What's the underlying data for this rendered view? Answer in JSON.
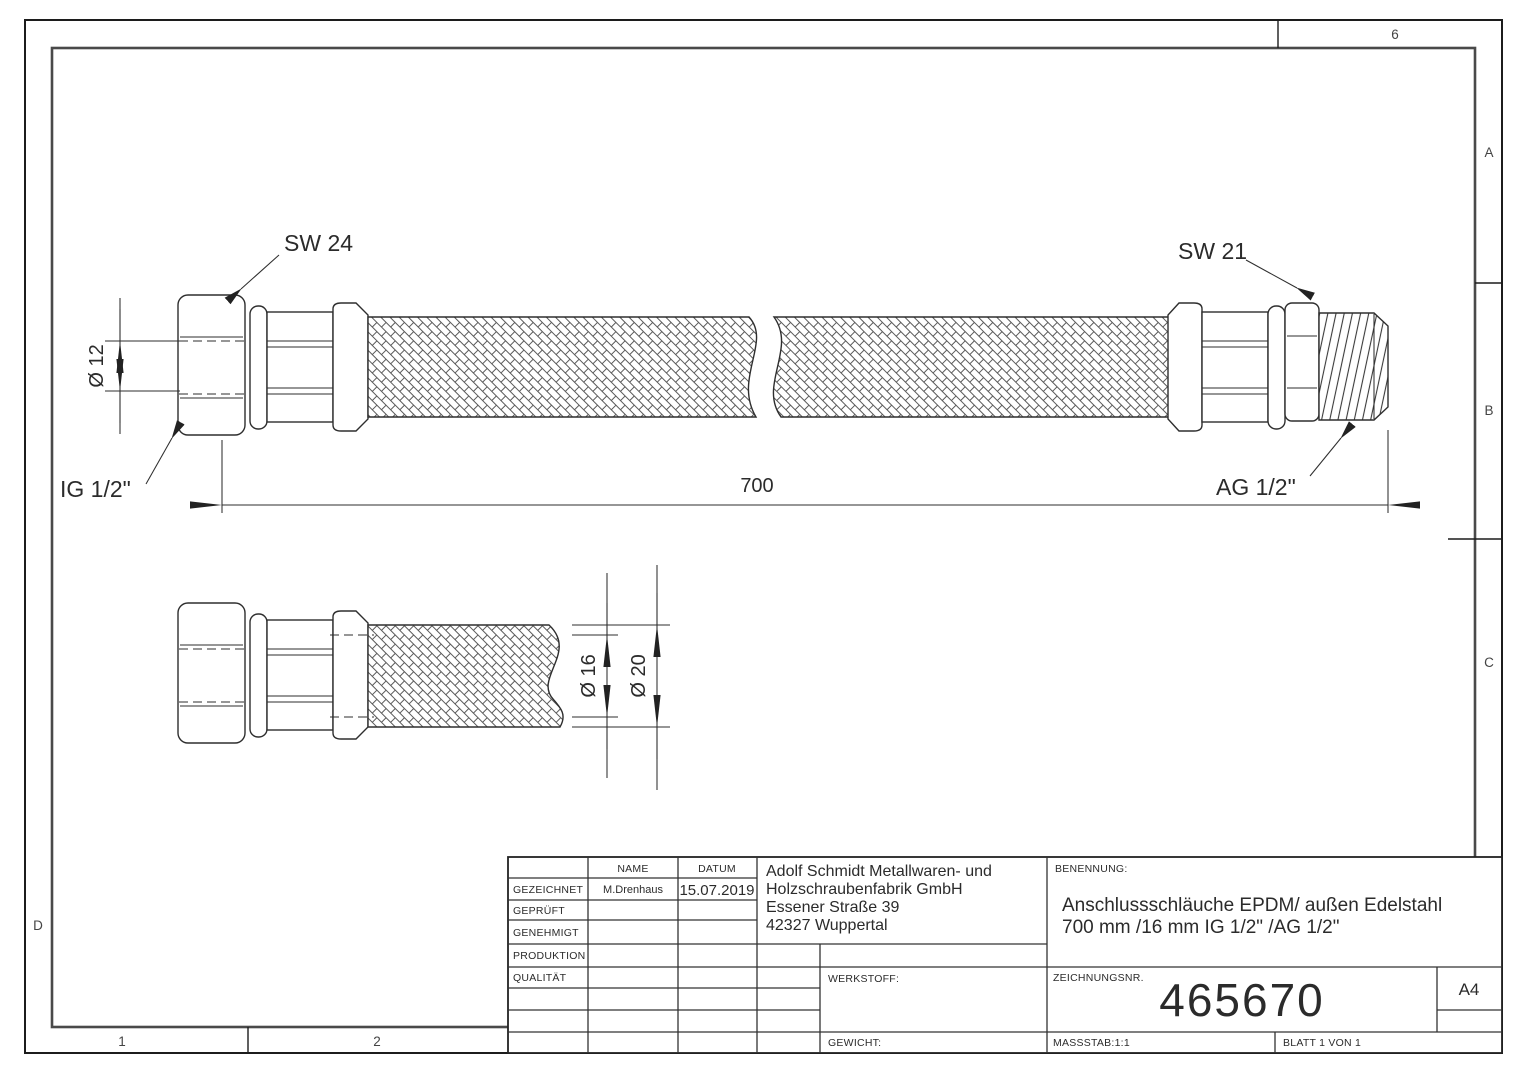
{
  "frame": {
    "zone_col_6": "6",
    "zone_col_1": "1",
    "zone_col_2": "2",
    "zone_row_a": "A",
    "zone_row_b": "B",
    "zone_row_c": "C",
    "zone_row_d": "D"
  },
  "annotations": {
    "sw24": "SW 24",
    "sw21": "SW 21",
    "ig_half_inch": "IG 1/2\"",
    "ag_half_inch": "AG 1/2\"",
    "length_700": "700",
    "dia_12": "Ø 12",
    "dia_16": "Ø 16",
    "dia_20": "Ø 20"
  },
  "title_block": {
    "header": {
      "name": "NAME",
      "datum": "DATUM"
    },
    "approval_rows": [
      {
        "label": "GEZEICHNET",
        "name": "M.Drenhaus",
        "datum": "15.07.2019"
      },
      {
        "label": "GEPRÜFT",
        "name": "",
        "datum": ""
      },
      {
        "label": "GENEHMIGT",
        "name": "",
        "datum": ""
      },
      {
        "label": "PRODUKTION",
        "name": "",
        "datum": ""
      },
      {
        "label": "QUALITÄT",
        "name": "",
        "datum": ""
      }
    ],
    "company": {
      "line1": "Adolf Schmidt Metallwaren- und",
      "line2": "Holzschraubenfabrik GmbH",
      "line3": "Essener Straße 39",
      "line4": "42327 Wuppertal"
    },
    "werkstoff_label": "WERKSTOFF:",
    "gewicht_label": "GEWICHT:",
    "benennung_label": "BENENNUNG:",
    "benennung_line1": "Anschlussschläuche EPDM/ außen Edelstahl",
    "benennung_line2": "700 mm /16 mm IG 1/2\" /AG 1/2\"",
    "zeichnungsnr_label": "ZEICHNUNGSNR.",
    "drawing_number": "465670",
    "paper_format": "A4",
    "massstab": "MASSSTAB:1:1",
    "blatt": "BLATT 1 VON 1"
  },
  "colors": {
    "line": "#2e2e2e",
    "background": "#ffffff"
  }
}
